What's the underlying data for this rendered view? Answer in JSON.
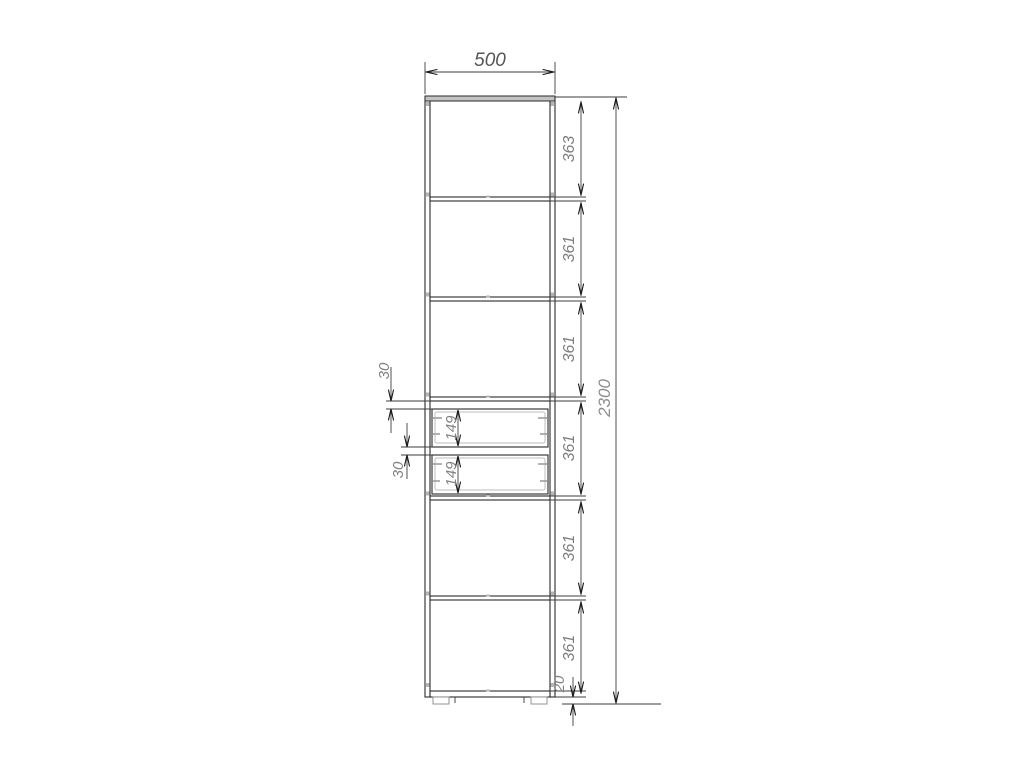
{
  "drawing": {
    "dimensions": {
      "width_mm": "500",
      "overall_height_mm": "2300",
      "sections": [
        "363",
        "361",
        "361",
        "361",
        "361",
        "361"
      ],
      "drawer_gaps": [
        "30",
        "30"
      ],
      "drawer_fronts": [
        "149",
        "149"
      ],
      "base_height_mm": "20"
    },
    "colors": {
      "outline": "#2b2b2b",
      "dimension_line": "#3d3d3d",
      "dimension_text": "#7d7d7d",
      "detail_gray": "#b5b5b5",
      "background": "#ffffff"
    }
  }
}
